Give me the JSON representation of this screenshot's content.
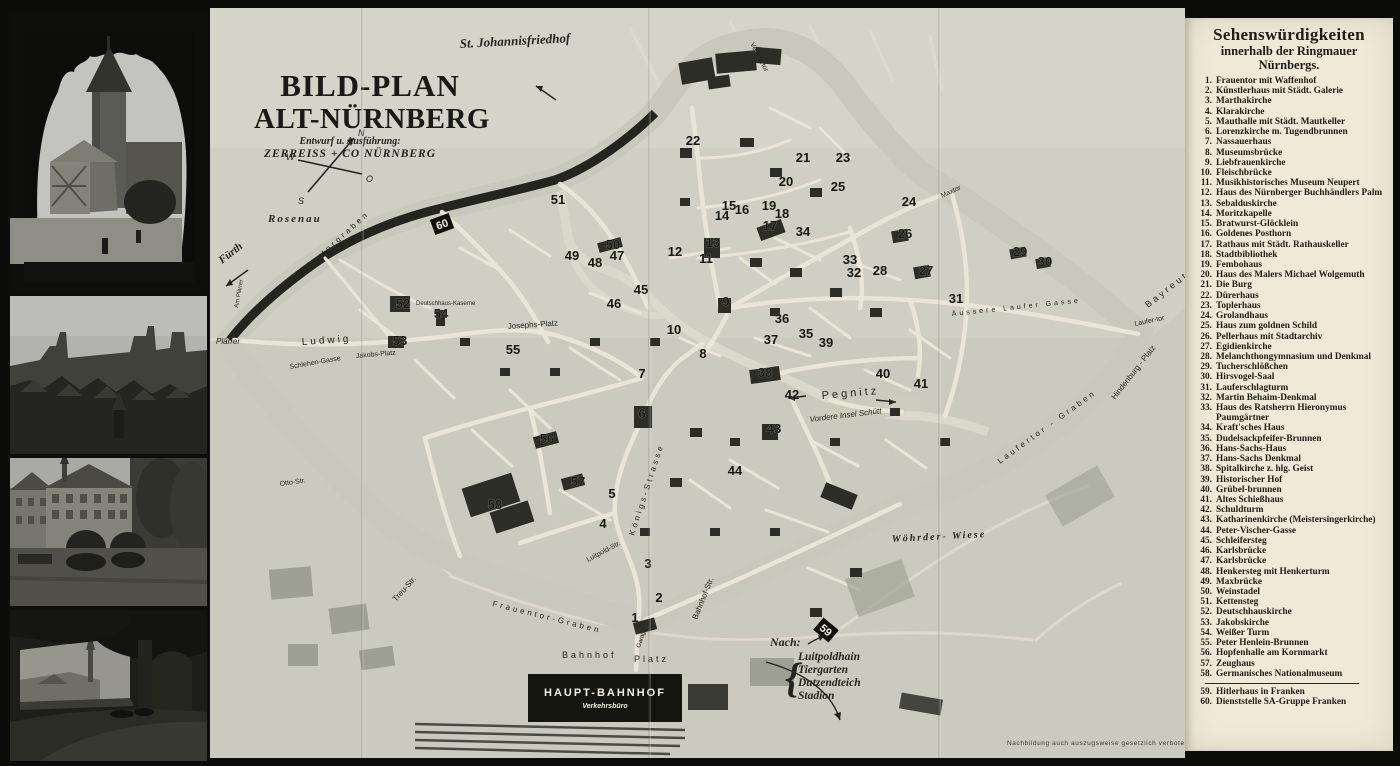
{
  "page": {
    "background": "#0b0b09",
    "paper": "#efe9d8",
    "map_paper": "#d0cfc3"
  },
  "title_block": {
    "line1": "BILD-PLAN",
    "line2": "ALT-NÜRNBERG",
    "sub1": "Entwurf u. Ausführung:",
    "sub2": "ZERREISS + CO NÜRNBERG"
  },
  "compass": {
    "n": "N",
    "s": "S",
    "w": "W",
    "o": "O"
  },
  "legend": {
    "title": "Sehenswürdigkeiten",
    "subtitle1": "innerhalb der Ringmauer",
    "subtitle2": "Nürnbergs.",
    "divider_after": 58,
    "items": [
      {
        "n": "1.",
        "label": "Frauentor mit Waffenhof"
      },
      {
        "n": "2.",
        "label": "Künstlerhaus mit Städt. Galerie"
      },
      {
        "n": "3.",
        "label": "Marthakirche"
      },
      {
        "n": "4.",
        "label": "Klarakirche"
      },
      {
        "n": "5.",
        "label": "Mauthalle mit Städt. Mautkeller"
      },
      {
        "n": "6.",
        "label": "Lorenzkirche m. Tugendbrunnen"
      },
      {
        "n": "7.",
        "label": "Nassauerhaus"
      },
      {
        "n": "8.",
        "label": "Museumsbrücke"
      },
      {
        "n": "9.",
        "label": "Liebfrauenkirche"
      },
      {
        "n": "10.",
        "label": "Fleischbrücke"
      },
      {
        "n": "11.",
        "label": "Musikhistorisches Museum Neupert"
      },
      {
        "n": "12.",
        "label": "Haus des Nürnberger Buchhändlers Palm"
      },
      {
        "n": "13.",
        "label": "Sebalduskirche"
      },
      {
        "n": "14.",
        "label": "Moritzkapelle"
      },
      {
        "n": "15.",
        "label": "Bratwurst-Glöcklein"
      },
      {
        "n": "16.",
        "label": "Goldenes Posthorn"
      },
      {
        "n": "17.",
        "label": "Rathaus mit Städt. Rathauskeller"
      },
      {
        "n": "18.",
        "label": "Stadtbibliothek"
      },
      {
        "n": "19.",
        "label": "Fembohaus"
      },
      {
        "n": "20.",
        "label": "Haus des Malers Michael Wolgemuth"
      },
      {
        "n": "21.",
        "label": "Die Burg"
      },
      {
        "n": "22.",
        "label": "Dürerhaus"
      },
      {
        "n": "23.",
        "label": "Toplerhaus"
      },
      {
        "n": "24.",
        "label": "Grolandhaus"
      },
      {
        "n": "25.",
        "label": "Haus zum goldnen Schild"
      },
      {
        "n": "26.",
        "label": "Pellerhaus mit Stadtarchiv"
      },
      {
        "n": "27.",
        "label": "Egidienkirche"
      },
      {
        "n": "28.",
        "label": "Melanchthongymnasium und Denkmal"
      },
      {
        "n": "29.",
        "label": "Tucherschlößchen"
      },
      {
        "n": "30.",
        "label": "Hirsvogel-Saal"
      },
      {
        "n": "31.",
        "label": "Lauferschlagturm"
      },
      {
        "n": "32.",
        "label": "Martin Behaim-Denkmal"
      },
      {
        "n": "33.",
        "label": "Haus des Ratsherrn Hieronymus Paumgärtner"
      },
      {
        "n": "34.",
        "label": "Kraft'sches Haus"
      },
      {
        "n": "35.",
        "label": "Dudelsackpfeifer-Brunnen"
      },
      {
        "n": "36.",
        "label": "Hans-Sachs-Haus"
      },
      {
        "n": "37.",
        "label": "Hans-Sachs Denkmal"
      },
      {
        "n": "38.",
        "label": "Spitalkirche z. hlg. Geist"
      },
      {
        "n": "39.",
        "label": "Historischer Hof"
      },
      {
        "n": "40.",
        "label": "Grübel-brunnen"
      },
      {
        "n": "41.",
        "label": "Altes Schießhaus"
      },
      {
        "n": "42.",
        "label": "Schuldturm"
      },
      {
        "n": "43.",
        "label": "Katharinenkirche (Meistersingerkirche)"
      },
      {
        "n": "44.",
        "label": "Peter-Vischer-Gasse"
      },
      {
        "n": "45.",
        "label": "Schleifersteg"
      },
      {
        "n": "46.",
        "label": "Karlsbrücke"
      },
      {
        "n": "47.",
        "label": "Karlsbrücke"
      },
      {
        "n": "48.",
        "label": "Henkersteg mit Henkerturm"
      },
      {
        "n": "49.",
        "label": "Maxbrücke"
      },
      {
        "n": "50.",
        "label": "Weinstadel"
      },
      {
        "n": "51.",
        "label": "Kettensteg"
      },
      {
        "n": "52.",
        "label": "Deutschhauskirche"
      },
      {
        "n": "53.",
        "label": "Jakobskirche"
      },
      {
        "n": "54.",
        "label": "Weißer Turm"
      },
      {
        "n": "55.",
        "label": "Peter Henlein-Brunnen"
      },
      {
        "n": "56.",
        "label": "Hopfenhalle am Kornmarkt"
      },
      {
        "n": "57.",
        "label": "Zeughaus"
      },
      {
        "n": "58.",
        "label": "Germanisches Nationalmuseum"
      },
      {
        "n": "59.",
        "label": "Hitlerhaus in Franken"
      },
      {
        "n": "60.",
        "label": "Dienststelle SA-Gruppe Franken"
      }
    ]
  },
  "map": {
    "labels": [
      {
        "t": "St. Johannisfriedhof",
        "x": 250,
        "y": 40,
        "r": -3,
        "s": 13,
        "c": "script"
      },
      {
        "t": "Rosenau",
        "x": 58,
        "y": 214,
        "r": 0,
        "s": 11,
        "c": "spit"
      },
      {
        "t": "Fürth",
        "x": 12,
        "y": 256,
        "r": -38,
        "s": 11,
        "c": "script"
      },
      {
        "t": "Plärrer",
        "x": 6,
        "y": 336,
        "r": 0,
        "s": 8,
        "c": "it"
      },
      {
        "t": "Ludwig",
        "x": 92,
        "y": 337,
        "r": -4,
        "s": 10,
        "c": "sp"
      },
      {
        "t": "Jakobs-Platz",
        "x": 146,
        "y": 350,
        "r": -5,
        "s": 7,
        "c": ""
      },
      {
        "t": "Josephs-Platz",
        "x": 298,
        "y": 321,
        "r": -4,
        "s": 8,
        "c": ""
      },
      {
        "t": "Schlehen-Gasse",
        "x": 80,
        "y": 361,
        "r": -10,
        "s": 7,
        "c": ""
      },
      {
        "t": "Otto-Str.",
        "x": 70,
        "y": 478,
        "r": -8,
        "s": 7,
        "c": ""
      },
      {
        "t": "Deutschhaus-Kaserne",
        "x": 206,
        "y": 297,
        "r": 0,
        "s": 6,
        "c": ""
      },
      {
        "t": "Pegnitz",
        "x": 612,
        "y": 391,
        "r": -5,
        "s": 11,
        "c": "sp"
      },
      {
        "t": "Vordere  Insel  Schütt",
        "x": 600,
        "y": 414,
        "r": -7,
        "s": 8,
        "c": "it"
      },
      {
        "t": "Wöhrder-   Wiese",
        "x": 682,
        "y": 534,
        "r": -3,
        "s": 10,
        "c": "spit"
      },
      {
        "t": "Maxtor",
        "x": 732,
        "y": 190,
        "r": -25,
        "s": 7,
        "c": ""
      },
      {
        "t": "Laufer-tor",
        "x": 925,
        "y": 318,
        "r": -12,
        "s": 7,
        "c": ""
      },
      {
        "t": "Hindenburg - Platz",
        "x": 905,
        "y": 392,
        "r": -52,
        "s": 8,
        "c": ""
      },
      {
        "t": "Bayreuth",
        "x": 938,
        "y": 300,
        "r": -38,
        "s": 9,
        "c": "sp"
      },
      {
        "t": "Vestnertor",
        "x": 540,
        "y": 36,
        "r": 62,
        "s": 7,
        "c": ""
      },
      {
        "t": "Spittlertorgraben",
        "x": 78,
        "y": 280,
        "r": -42,
        "s": 8,
        "c": "sp"
      },
      {
        "t": "Frauentor-Graben",
        "x": 282,
        "y": 598,
        "r": 14,
        "s": 8,
        "c": "sp"
      },
      {
        "t": "Königs-Strasse",
        "x": 424,
        "y": 528,
        "r": -72,
        "s": 8,
        "c": "sp"
      },
      {
        "t": "Bahnhof-Str.",
        "x": 487,
        "y": 612,
        "r": -68,
        "s": 8,
        "c": ""
      },
      {
        "t": "Bahnhof",
        "x": 352,
        "y": 650,
        "r": 0,
        "s": 9,
        "c": "sp"
      },
      {
        "t": "Platz",
        "x": 424,
        "y": 654,
        "r": 0,
        "s": 9,
        "c": "sp"
      },
      {
        "t": "Äussere Laufer Gasse",
        "x": 742,
        "y": 308,
        "r": -6,
        "s": 7,
        "c": "sp"
      },
      {
        "t": "Laufertor - Graben",
        "x": 790,
        "y": 456,
        "r": -36,
        "s": 8,
        "c": "sp"
      },
      {
        "t": "Luitpold-Str.",
        "x": 378,
        "y": 554,
        "r": -28,
        "s": 7,
        "c": ""
      },
      {
        "t": "Treu-Str.",
        "x": 186,
        "y": 594,
        "r": -48,
        "s": 8,
        "c": ""
      },
      {
        "t": "Garage",
        "x": 430,
        "y": 640,
        "r": -72,
        "s": 6,
        "c": ""
      },
      {
        "t": "Am Plärrer",
        "x": 28,
        "y": 300,
        "r": -80,
        "s": 6,
        "c": ""
      }
    ],
    "markers": [
      [
        1,
        425,
        614
      ],
      [
        2,
        449,
        594
      ],
      [
        3,
        438,
        560
      ],
      [
        4,
        393,
        520
      ],
      [
        5,
        402,
        490
      ],
      [
        6,
        432,
        410
      ],
      [
        7,
        432,
        370
      ],
      [
        8,
        493,
        350
      ],
      [
        9,
        516,
        298
      ],
      [
        10,
        464,
        326
      ],
      [
        11,
        496,
        255
      ],
      [
        12,
        465,
        248
      ],
      [
        13,
        503,
        239
      ],
      [
        14,
        512,
        212
      ],
      [
        15,
        519,
        202
      ],
      [
        16,
        532,
        206
      ],
      [
        17,
        560,
        222
      ],
      [
        18,
        572,
        210
      ],
      [
        19,
        559,
        202
      ],
      [
        20,
        576,
        178
      ],
      [
        21,
        593,
        154
      ],
      [
        22,
        483,
        137
      ],
      [
        23,
        633,
        154
      ],
      [
        24,
        699,
        198
      ],
      [
        25,
        628,
        183
      ],
      [
        26,
        695,
        230
      ],
      [
        27,
        716,
        267
      ],
      [
        28,
        670,
        267
      ],
      [
        29,
        810,
        248
      ],
      [
        30,
        835,
        258
      ],
      [
        31,
        746,
        295
      ],
      [
        32,
        644,
        269
      ],
      [
        33,
        640,
        256
      ],
      [
        34,
        593,
        228
      ],
      [
        35,
        596,
        330
      ],
      [
        36,
        572,
        315
      ],
      [
        37,
        561,
        336
      ],
      [
        38,
        555,
        369
      ],
      [
        39,
        616,
        339
      ],
      [
        40,
        673,
        370
      ],
      [
        41,
        711,
        380
      ],
      [
        42,
        582,
        391
      ],
      [
        43,
        564,
        425
      ],
      [
        44,
        525,
        467
      ],
      [
        45,
        431,
        286
      ],
      [
        46,
        404,
        300
      ],
      [
        47,
        407,
        252
      ],
      [
        48,
        385,
        259
      ],
      [
        49,
        362,
        252
      ],
      [
        50,
        403,
        241
      ],
      [
        51,
        348,
        196
      ],
      [
        52,
        193,
        300
      ],
      [
        53,
        190,
        337
      ],
      [
        54,
        231,
        310
      ],
      [
        55,
        303,
        346
      ],
      [
        56,
        337,
        435
      ],
      [
        57,
        368,
        478
      ],
      [
        58,
        285,
        501
      ]
    ],
    "badges": [
      {
        "n": "60",
        "x": 232,
        "y": 216,
        "r": -20
      },
      {
        "n": "59",
        "x": 616,
        "y": 622,
        "r": 40
      }
    ],
    "station": {
      "line1": "HAUPT-BAHNHOF",
      "line2": "Verkehrsbüro"
    },
    "nach_note": {
      "intro": "Nach:",
      "destinations": [
        "Luitpoldhain",
        "Tiergarten",
        "Dutzendteich",
        "Stadion"
      ]
    },
    "fine_print": "Nachbildung auch auszugsweise gesetzlich verboten"
  },
  "photos": [
    {
      "name": "sinwellturm-through-arch"
    },
    {
      "name": "castle-skyline-panorama"
    },
    {
      "name": "heilig-geist-spital-on-pegnitz"
    },
    {
      "name": "park-terrace-with-spire-view"
    }
  ]
}
